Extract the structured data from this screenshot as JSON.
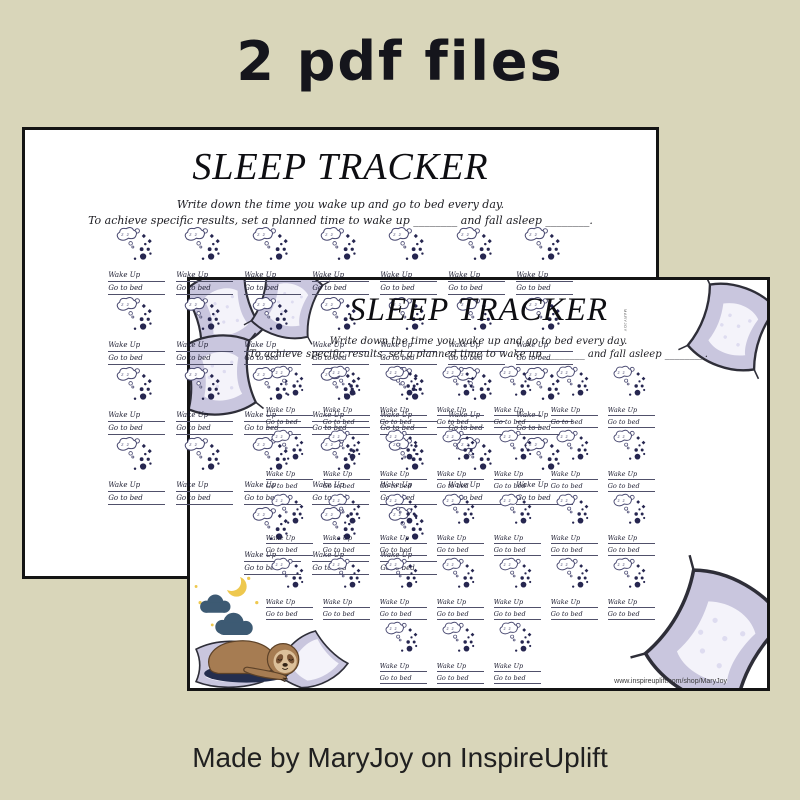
{
  "banner": {
    "title": "2 pdf files"
  },
  "footer": {
    "caption": "Made by MaryJoy on InspireUplift"
  },
  "tracker_page": {
    "title": "SLEEP TRACKER",
    "instruction_line1": "Write down the time you wake up and go to bed every day.",
    "instruction_line2": "To achieve specific results, set a planned time to wake up ________ and fall asleep ________.",
    "cell": {
      "wake_label": "Wake Up",
      "bed_label": "Go to bed",
      "cloud_text": "z z"
    },
    "grid": {
      "columns": 7,
      "full_rows": 4,
      "last_row_cells": 3
    },
    "footer_url": "www.inspireuplift.com/shop/MaryJoy",
    "watermark": "MARYJOY"
  },
  "icons": {
    "moon": "sleeping-moon-with-cloud-icon",
    "pillow": "pillow-icon",
    "sloth": "sleeping-sloth-scene",
    "night": "night-clouds-and-moon"
  },
  "colors": {
    "canvas_bg": "#d9d6ba",
    "page_bg": "#ffffff",
    "moon_outline": "#4a4a72",
    "moon_dots": "#262650",
    "pillow_lavender": "#c9c6de",
    "night_cloud": "#3d5a73",
    "moon_yellow": "#eec84e",
    "sloth_brown": "#a67c52",
    "sloth_face": "#dcc09a"
  }
}
